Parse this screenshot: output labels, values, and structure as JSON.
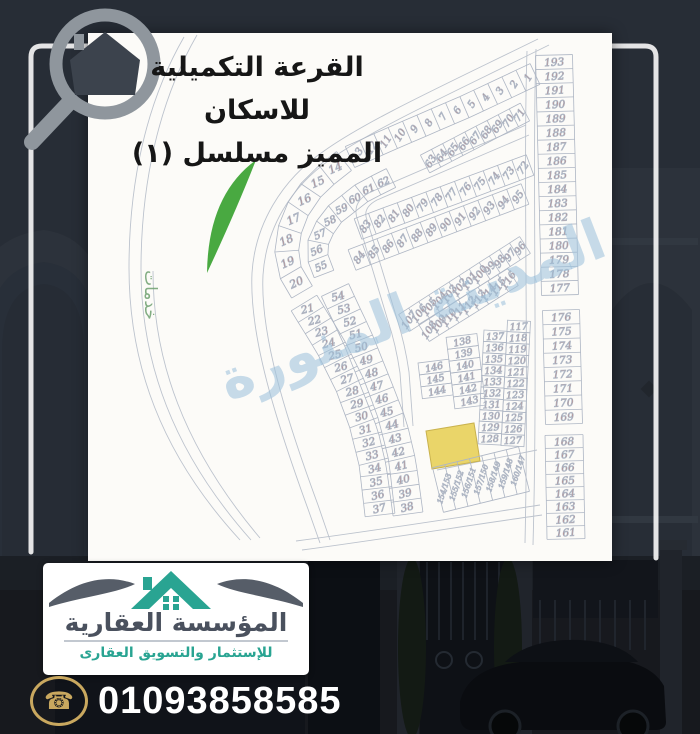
{
  "page": {
    "bg_color": "#272d36"
  },
  "title": {
    "line1": "القرعة التكميلية للاسكان",
    "line2": "المميز مسلسل (١)"
  },
  "map": {
    "services_label": "خدمات",
    "watermark_text": "المدينة المنورة",
    "number_color": "#c25745",
    "line_color": "#aeb6c4",
    "road_color": "#b6bdc9",
    "park_color": "#3fa437",
    "highlight_color": "#ead569",
    "strips": [
      {
        "id": "arc-outer-a",
        "nums": [
          "1",
          "2",
          "3",
          "4",
          "5",
          "6",
          "7",
          "8",
          "9",
          "10",
          "11",
          "12",
          "13"
        ]
      },
      {
        "id": "arc-outer-b",
        "nums": [
          "14",
          "15",
          "16",
          "17",
          "18",
          "19",
          "20"
        ]
      },
      {
        "id": "arc-inner-a",
        "nums": [
          "71",
          "70",
          "69",
          "68",
          "67",
          "66",
          "65",
          "64",
          "63"
        ]
      },
      {
        "id": "arc-inner-b",
        "nums": [
          "62",
          "61",
          "60",
          "59",
          "58",
          "57",
          "56",
          "55"
        ]
      },
      {
        "id": "left-outer",
        "nums": [
          "21",
          "22",
          "23",
          "24",
          "25",
          "26",
          "27",
          "28",
          "29",
          "30",
          "31",
          "32",
          "33",
          "34",
          "35",
          "36",
          "37"
        ]
      },
      {
        "id": "left-inner",
        "nums": [
          "54",
          "53",
          "52",
          "51",
          "50",
          "49",
          "48",
          "47",
          "46",
          "45",
          "44",
          "43",
          "42",
          "41",
          "40",
          "39",
          "38"
        ]
      },
      {
        "id": "mid-row-1",
        "nums": [
          "72",
          "73",
          "74",
          "75",
          "76",
          "77",
          "78",
          "79",
          "80",
          "81",
          "82",
          "83"
        ]
      },
      {
        "id": "mid-row-2",
        "nums": [
          "95",
          "94",
          "93",
          "92",
          "91",
          "90",
          "89",
          "88",
          "87",
          "86",
          "85",
          "84"
        ]
      },
      {
        "id": "mid-row-3",
        "nums": [
          "96",
          "97",
          "98",
          "99",
          "100",
          "101",
          "102",
          "103",
          "104",
          "105",
          "106",
          "107"
        ]
      },
      {
        "id": "mid-row-4",
        "nums": [
          "116",
          "115",
          "114",
          "113",
          "112",
          "111",
          "110",
          "109",
          "108"
        ]
      },
      {
        "id": "right-col-a",
        "nums": [
          "193",
          "192",
          "191",
          "190",
          "189",
          "188",
          "187",
          "186",
          "185",
          "184",
          "183",
          "182",
          "181",
          "180",
          "179",
          "178",
          "177"
        ]
      },
      {
        "id": "right-col-b",
        "nums": [
          "176",
          "175",
          "174",
          "173",
          "172",
          "171",
          "170",
          "169"
        ]
      },
      {
        "id": "right-col-c",
        "nums": [
          "168",
          "167",
          "166",
          "165",
          "164",
          "163",
          "162",
          "161"
        ]
      },
      {
        "id": "bottom-pairs",
        "nums": [
          "154/153",
          "155/152",
          "156/151",
          "157/150",
          "158/149",
          "159/148",
          "160/147"
        ]
      }
    ],
    "grids": [
      {
        "id": "block-a",
        "cols": [
          [
            "137",
            "136",
            "135",
            "134",
            "133",
            "132",
            "131",
            "130",
            "129",
            "128"
          ],
          [
            "117",
            "118",
            "119",
            "120",
            "121",
            "122",
            "123",
            "124",
            "125",
            "126",
            "127"
          ]
        ]
      },
      {
        "id": "block-b",
        "cols": [
          [
            "146",
            "145",
            "144"
          ],
          [
            "138",
            "139",
            "140",
            "141",
            "142",
            "143"
          ]
        ]
      }
    ]
  },
  "footer": {
    "brand_name": "المؤسسة العقارية",
    "brand_tagline": "للإستثمار والتسويق العقارى",
    "phone": "01093858585"
  }
}
